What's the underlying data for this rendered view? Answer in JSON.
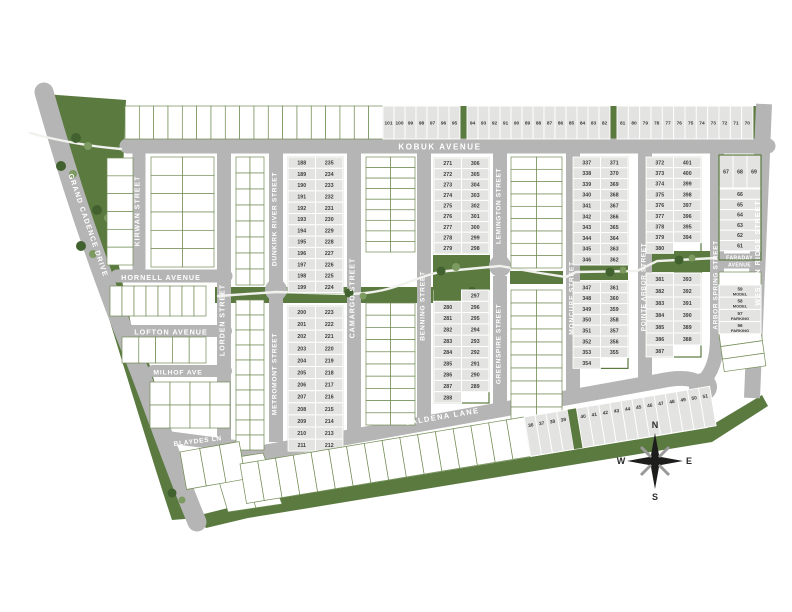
{
  "title": "community site plan map",
  "colors": {
    "road": "#b5b5b5",
    "green": "#5b7a40",
    "tree_dark": "#41612f",
    "tree_light": "#7d9a60",
    "lot_fill": "#e3e3e1",
    "lot_text": "#3b3b3b",
    "gridline": "#6f8c52",
    "street_text": "#ffffff",
    "path": "#f1f1ee",
    "compass": "#1d1d1b"
  },
  "streets": {
    "kobuk": "KOBUK AVENUE",
    "kirwan": "KIRWAN STREET",
    "hornell": "HORNELL AVENUE",
    "lofton": "LOFTON AVENUE",
    "milhof": "MILHOF AVE",
    "blaydes": "BLAYDES LN",
    "grand_cadence": "GRAND CADENCE DRIVE",
    "lorden": "LORDEN STREET",
    "dunkirk": "DUNKIRK RIVER STREET",
    "metromont": "METROMONT STREET",
    "camargo": "CAMARGO STREET",
    "benning": "BENNING STREET",
    "lemington": "LEMINGTON STREET",
    "greenspire": "GREENSPIRE STREET",
    "moncure": "MONCURE STREET",
    "pointe_arbor": "POINTE ARBOR STREET",
    "arbor_spring": "ARBOR SPRING STREET",
    "faraday": [
      "FARADAY",
      "AVENUE"
    ],
    "weston_ridge": "WESTON RIDGE STREET",
    "jaldena": "JALDENA LANE"
  },
  "compass": {
    "north": "N",
    "east": "E",
    "south": "S",
    "west": "W"
  },
  "lots": {
    "kobuk_north_row": [
      "101",
      "100",
      "99",
      "98",
      "97",
      "96",
      "95",
      "94",
      "93",
      "92",
      "91",
      "90",
      "89",
      "88",
      "87",
      "86",
      "85",
      "84",
      "83",
      "82",
      "81",
      "80",
      "79",
      "78",
      "77",
      "76",
      "75",
      "74",
      "73",
      "72",
      "71",
      "70"
    ],
    "dunkirk_camargo": {
      "west": [
        "188",
        "189",
        "190",
        "191",
        "192",
        "193",
        "194",
        "195",
        "196",
        "197",
        "198",
        "199"
      ],
      "east": [
        "235",
        "234",
        "233",
        "232",
        "231",
        "230",
        "229",
        "228",
        "227",
        "226",
        "225",
        "224"
      ]
    },
    "metromont_camargo": {
      "west": [
        "200",
        "201",
        "202",
        "203",
        "204",
        "205",
        "206",
        "207",
        "208",
        "209",
        "210",
        "211"
      ],
      "east": [
        "223",
        "222",
        "221",
        "220",
        "219",
        "218",
        "217",
        "216",
        "215",
        "214",
        "213",
        "212"
      ]
    },
    "benning_upper": {
      "west": [
        "271",
        "272",
        "273",
        "274",
        "275",
        "276",
        "277",
        "278",
        "279"
      ],
      "east": [
        "306",
        "305",
        "304",
        "303",
        "302",
        "301",
        "300",
        "299",
        "298"
      ]
    },
    "benning_lower": {
      "west": [
        "",
        "280",
        "281",
        "282",
        "283",
        "284",
        "285",
        "286",
        "287",
        "288"
      ],
      "east": [
        "297",
        "296",
        "295",
        "294",
        "293",
        "292",
        "291",
        "290",
        "289",
        ""
      ]
    },
    "moncure_upper": {
      "west": [
        "337",
        "338",
        "339",
        "340",
        "341",
        "342",
        "343",
        "344",
        "345",
        "346"
      ],
      "east": [
        "371",
        "370",
        "369",
        "368",
        "367",
        "366",
        "365",
        "364",
        "363",
        "362"
      ]
    },
    "moncure_lower": {
      "west": [
        "347",
        "348",
        "349",
        "350",
        "351",
        "352",
        "353",
        "354"
      ],
      "east": [
        "361",
        "360",
        "359",
        "358",
        "357",
        "356",
        "355",
        ""
      ]
    },
    "pointe_upper": {
      "west": [
        "372",
        "373",
        "374",
        "375",
        "376",
        "377",
        "378",
        "379",
        "380"
      ],
      "east": [
        "401",
        "400",
        "399",
        "398",
        "397",
        "396",
        "395",
        "394",
        ""
      ]
    },
    "pointe_lower": {
      "west": [
        "381",
        "382",
        "383",
        "384",
        "385",
        "386",
        "387"
      ],
      "east": [
        "393",
        "392",
        "391",
        "390",
        "389",
        "388",
        ""
      ]
    },
    "faraday_row": [
      "67",
      "68",
      "69"
    ],
    "faraday_stack": [
      "66",
      "65",
      "64",
      "63",
      "62",
      "61"
    ],
    "model_parking": [
      {
        "num": "59",
        "use": "MODEL"
      },
      {
        "num": "58",
        "use": "MODEL"
      },
      {
        "num": "57",
        "use": "PARKING"
      },
      {
        "num": "56",
        "use": "PARKING"
      }
    ],
    "jaldena_south_west": [
      "36",
      "37",
      "38",
      "39"
    ],
    "jaldena_south_east": [
      "40",
      "41",
      "42",
      "43",
      "44",
      "45",
      "46",
      "47",
      "48",
      "49",
      "50",
      "51"
    ]
  }
}
